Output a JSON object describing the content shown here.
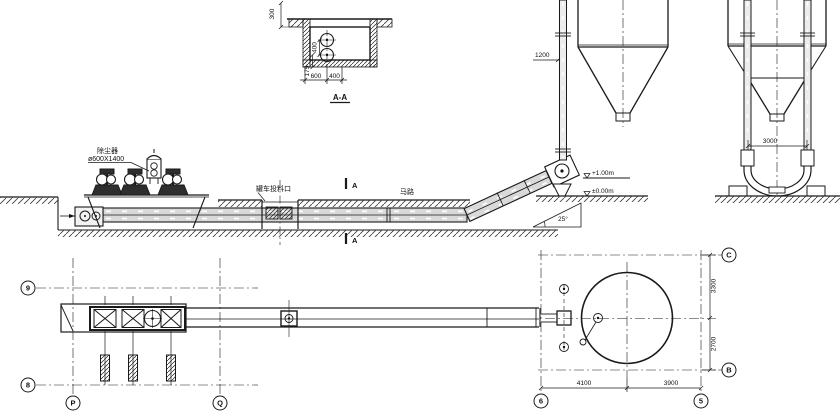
{
  "drawing": {
    "section_aa": {
      "title": "A-A",
      "dim_depth": "300",
      "dim_circle_spacing": "400",
      "dim_floor_offset": "175",
      "dim_width_left": "600",
      "dim_width_right": "400"
    },
    "elevation": {
      "dust_collector_name": "除尘器",
      "dust_collector_size": "ø600X1400",
      "feed_port_label": "罐车投料口",
      "road_label": "马路",
      "section_mark_top": "A",
      "section_mark_bottom": "A",
      "incline_angle": "25°",
      "level_discharge": "+1.00m",
      "level_ground": "±0.00m",
      "dim_pipe_offset": "1200",
      "dim_pipe_spacing": "3000"
    },
    "plan": {
      "grid_row_9": "9",
      "grid_row_8": "8",
      "grid_col_p": "P",
      "grid_col_q": "Q",
      "grid_row_c": "C",
      "grid_row_b": "B",
      "grid_col_6": "6",
      "grid_col_5": "5",
      "dim_c_to_center": "3300",
      "dim_center_to_b": "2700",
      "dim_left_span": "4100",
      "dim_right_span": "3900"
    }
  }
}
